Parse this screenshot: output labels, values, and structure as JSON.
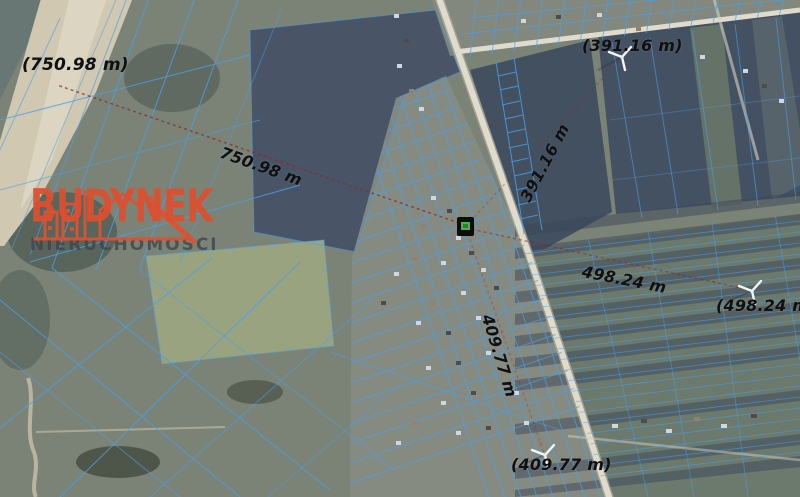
{
  "watermark": {
    "brand": "BUDYNEK",
    "subtitle": "NIERUCHOMOŚCI",
    "brand_color": "#dd4f2e",
    "subtitle_color": "#3e444a"
  },
  "map": {
    "type": "aerial-cadastral",
    "colors": {
      "parcel_line_blue": "#4aa2ea",
      "measurement_red": "#8f2727",
      "label_black": "#101010",
      "marker_green": "#49b34a",
      "road_light": "#e8e2ce"
    },
    "icons": {
      "wind_turbine": "wind-turbine-rotor",
      "logo_house": "house-skyline-line-art",
      "property_marker": "green-parcel-marker"
    },
    "measurements": [
      {
        "line_label": "750.98 m",
        "endpoint_label": "(750.98 m)"
      },
      {
        "line_label": "391.16 m",
        "endpoint_label": "(391.16 m)"
      },
      {
        "line_label": "498.24 m",
        "endpoint_label": "(498.24 m)"
      },
      {
        "line_label": "409.77 m",
        "endpoint_label": "(409.77 m)"
      }
    ]
  }
}
